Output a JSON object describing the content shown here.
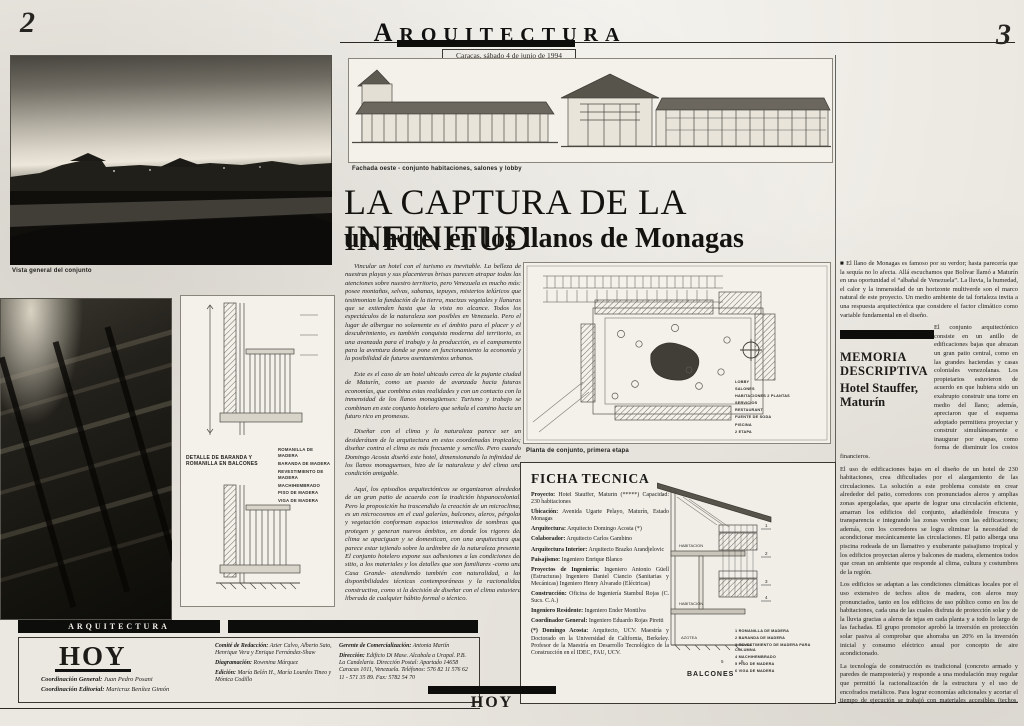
{
  "page": {
    "left_folio": "2",
    "right_folio": "3",
    "masthead": "ARQUITECTURA",
    "dateline": "Caracas, sábado 4 de junio de 1994",
    "paper_color": "#ebe8e1",
    "ink_color": "#1c1b18"
  },
  "headline": {
    "title": "LA CAPTURA DE LA INFINITUD",
    "subtitle": "un hotel en los llanos de Monagas"
  },
  "captions": {
    "main_photo": "Vista general del conjunto",
    "elevation": "Fachada oeste - conjunto habitaciones, salones y lobby",
    "site_plan": "Planta de conjunto, primera etapa",
    "detail_title": "DETALLE DE BARANDA Y ROMANILLA EN BALCONES",
    "balcony_section": "BALCONES"
  },
  "intro": {
    "paragraphs": [
      "Vincular un hotel con el turismo es inevitable. La belleza de nuestras playas y sus placenteras brisas parecen atrapar todas las atenciones sobre nuestro territorio, pero Venezuela es mucho más: posee montañas, selvas, sabanas, tepuyes, misterios telúricos que testimonian la fundación de la tierra, macizas vegetales y llanuras que se extienden hasta que la vista no alcance. Todos los espectáculos de la naturaleza son posibles en Venezuela. Pero el lugar de albergue no solamente es el ámbito para el placer y el descubrimiento, es también conquista moderna del territorio, es una avanzada para el trabajo y la producción, es el campamento para la aventura donde se pone en funcionamiento la economía y la posibilidad de futuros asentamientos urbanos.",
      "Este es el caso de un hotel ubicado cerca de la pujante ciudad de Maturín, como un puesto de avanzada hacia futuras economías, que combina estas realidades y con un contacto con la inmensidad de los llanos monagüenses: Turismo y trabajo se combinan en este conjunto hotelero que señala el camino hacia un futuro rico en promesas.",
      "Diseñar con el clima y la naturaleza parece ser un desiderátum de la arquitectura en estas coordenadas tropicales; diseñar contra el clima es más frecuente y sencillo. Pero cuando Domingo Acosta diseñó este hotel, dimensionando la infinidad de los llanos monaguenses, hizo de la naturaleza y del clima una condición amigable.",
      "Aquí, los episodios arquitectónicos se organizaron alrededor de un gran patio de acuerdo con la tradición hispanocolonial. Pero la proposición ha trascendido la creación de un microclima; es un microcosmos en el cual galerías, balcones, aleros, pérgolas y vegetación conforman espacios intermedios de sombras que protegen y generan nuevos ámbitos, en donde los rigores del clima se apaciguan y se domestican, con una arquitectura que parece estar tejiendo sobre la urdimbre de la naturaleza presente. El conjunto hotelero expone sus adhesiones a las condiciones del sitio, a los materiales y los detalles que son familiares -como una Casa Grande- atendiendo también con naturalidad, a las disponibilidades técnicas contemporáneas y la racionalidad constructiva, como si la decisión de diseñar con el clima estuviera liberada de cualquier hábito formal o técnico."
    ]
  },
  "plan": {
    "legend": [
      "LOBBY",
      "SALONES",
      "HABITACIONES 2 PLANTAS",
      "SERVICIOS",
      "RESTAURANT",
      "FUENTE DE SODA",
      "PISCINA",
      "2 ETAPA"
    ]
  },
  "detail": {
    "legend": [
      "ROMANILLA DE MADERA",
      "BARANDA DE MADERA",
      "REVESTIMIENTO DE MADERA",
      "MACHIHEMBRADO",
      "PISO DE MADERA",
      "VIGA DE MADERA"
    ]
  },
  "section": {
    "labels": [
      "HABITACION",
      "HABITACION",
      "AZOTEA"
    ],
    "callouts": [
      "1",
      "2",
      "3",
      "4",
      "5",
      "6"
    ],
    "legend": [
      "1  ROMANILLA DE MADERA",
      "2  BARANDA DE MADERA",
      "3  REVESTIMIENTO DE MADERA PARA COLUMNA",
      "4  MACHIHEMBRADO",
      "5  PISO DE MADERA",
      "6  VIGA DE MADERA"
    ]
  },
  "ficha": {
    "title": "FICHA TECNICA",
    "entries": [
      {
        "label": "Proyecto:",
        "text": "Hotel Stauffer, Maturín (*****) Capacidad: 230 habitaciones"
      },
      {
        "label": "Ubicación:",
        "text": "Avenida Ugarte Pelayo, Maturín, Estado Monagas"
      },
      {
        "label": "Arquitectura:",
        "text": "Arquitecto Domingo Acosta (*)"
      },
      {
        "label": "Colaborador:",
        "text": "Arquitecto Carlos Gambino"
      },
      {
        "label": "Arquitectura Interior:",
        "text": "Arquitecto Brazko Arandjelovic"
      },
      {
        "label": "Paisajismo:",
        "text": "Ingeniero Enrique Blanco"
      },
      {
        "label": "Proyectos de Ingeniería:",
        "text": "Ingeniero Antonio Güell (Estructuras) Ingeniero Daniel Ciancio (Sanitarias y Mecánicas) Ingeniero Henry Alvarado (Eléctricas)"
      },
      {
        "label": "Construcción:",
        "text": "Oficina de Ingeniería Stambul Rojas (C. Sucs. C.A.)"
      },
      {
        "label": "Ingeniero Residente:",
        "text": "Ingeniero Ender Montilva"
      },
      {
        "label": "Coordinador General:",
        "text": "Ingeniero Eduardo Rojas Piretti"
      },
      {
        "label": "(*) Domingo Acosta:",
        "text": "Arquitecto, UCV. Maestría y Doctorado en la Universidad de California, Berkeley. Profesor de la Maestría en Desarrollo Tecnológico de la Construcción en el IDEC, FAU, UCV."
      }
    ]
  },
  "memoria": {
    "kicker": {
      "line1": "MEMORIA",
      "line2": "DESCRIPTIVA",
      "line3": "Hotel Stauffer,",
      "line4": "Maturín"
    },
    "paragraphs": [
      "■ El llano de Monagas es famoso por su verdor; hasta parecería que la sequía no lo afecta. Allá escuchamos que Bolívar llamó a Maturín en una oportunidad el “albañal de Venezuela”. La lluvia, la humedad, el calor y la inmensidad de un horizonte multiverde son el marco natural de este proyecto. Un medio ambiente de tal fortaleza invita a una respuesta arquitectónica que considere el factor climático como variable fundamental en el diseño.",
      "El conjunto arquitectónico consiste en un anillo de edificaciones bajas que abrazan un gran patio central, como en las grandes haciendas y casas coloniales venezolanas. Los propietarios estuvieron de acuerdo en que hubiera sido un exabrupto construir una torre en medio del llano; además, apreciaron que el esquema adoptado permitiera proyectar y construir simultáneamente e inaugurar por etapas, como forma de disminuir los costos financieros.",
      "El uso de edificaciones bajas en el diseño de un hotel de 230 habitaciones, crea dificultades por el alargamiento de las circulaciones. La solución a este problema consiste en crear alrededor del patio, corredores con pronunciados aleros y amplias zonas apergoladas, que aparte de lograr una circulación eficiente, amarran los edificios del conjunto, añadiéndole frescura y transparencia e integrando las zonas verdes con las edificaciones; además, con los corredores se logra eliminar la necesidad de acondicionar mecánicamente las circulaciones. El patio alberga una piscina rodeada de un llamativo y exuberante paisajismo tropical y los edificios proyectan aleros y balcones de madera, elementos todos que crean un ambiente que responde al clima, cultura y costumbres de la región.",
      "Los edificios se adaptan a las condiciones climáticas locales por el uso extensivo de techos altos de madera, con aleros muy pronunciados, tanto en los edificios de uso público como en los de habitaciones, cada una de las cuales disfruta de protección solar y de la lluvia gracias a aleros de tejas en cada planta y a todo lo largo de las fachadas. El grupo promotor aprobó la inversión en protección solar pasiva al comprobar que ahorraba un 20% en la inversión inicial y consumo eléctrico anual por concepto de aire acondicionado.",
      "La tecnología de construcción es tradicional (concreto armado y paredes de mampostería) y responde a una modulación muy regular que permitió la racionalización de la estructura y el uso de encofrados metálicos. Para lograr economías adicionales y acortar el tiempo de ejecución se trabajó con materiales accesibles (techos, balcones y celosías de madera, tejas y pisos de arcilla, paredes texturizadas, y ventanas de aluminio y vidrio), lo cual ha representado un aliciente para intentar lograr una arquitectura que con relativa sencillez resuelva los problemas climáticos, económicos funcionales y de confort típicos de una edificación hotelera."
    ]
  },
  "footer": {
    "section_bar": "ARQUITECTURA",
    "brand": "HOY",
    "bottom_brand": "HOY",
    "coordination": [
      {
        "label": "Coordinación General:",
        "text": "Juan Pedro Posani"
      },
      {
        "label": "Coordinación Editorial:",
        "text": "Maricruz Benítez Gimón"
      }
    ],
    "staff": [
      {
        "label": "Comité de Redacción:",
        "text": "Azier Calvo, Alberto Sato, Henrique Vera y Enrique Fernández-Shaw"
      },
      {
        "label": "Diagramación:",
        "text": "Rowmina Márquez"
      },
      {
        "label": "Edición:",
        "text": "María Belén H., María Lourdes Tineo y Mónica Codillo"
      }
    ],
    "commercial": [
      {
        "label": "Gerente de Comercialización:",
        "text": "Antonia Martín"
      },
      {
        "label": "Dirección:",
        "text": "Edificio Di Mase. Alcabala a Urapal. P.B. La Candelaria. Dirección Postal: Apartado 14658 Caracas 1011, Venezuela. Teléfonos: 576 82 11 576 62 11 - 571 35 89. Fax: 5782 54 70"
      }
    ]
  }
}
